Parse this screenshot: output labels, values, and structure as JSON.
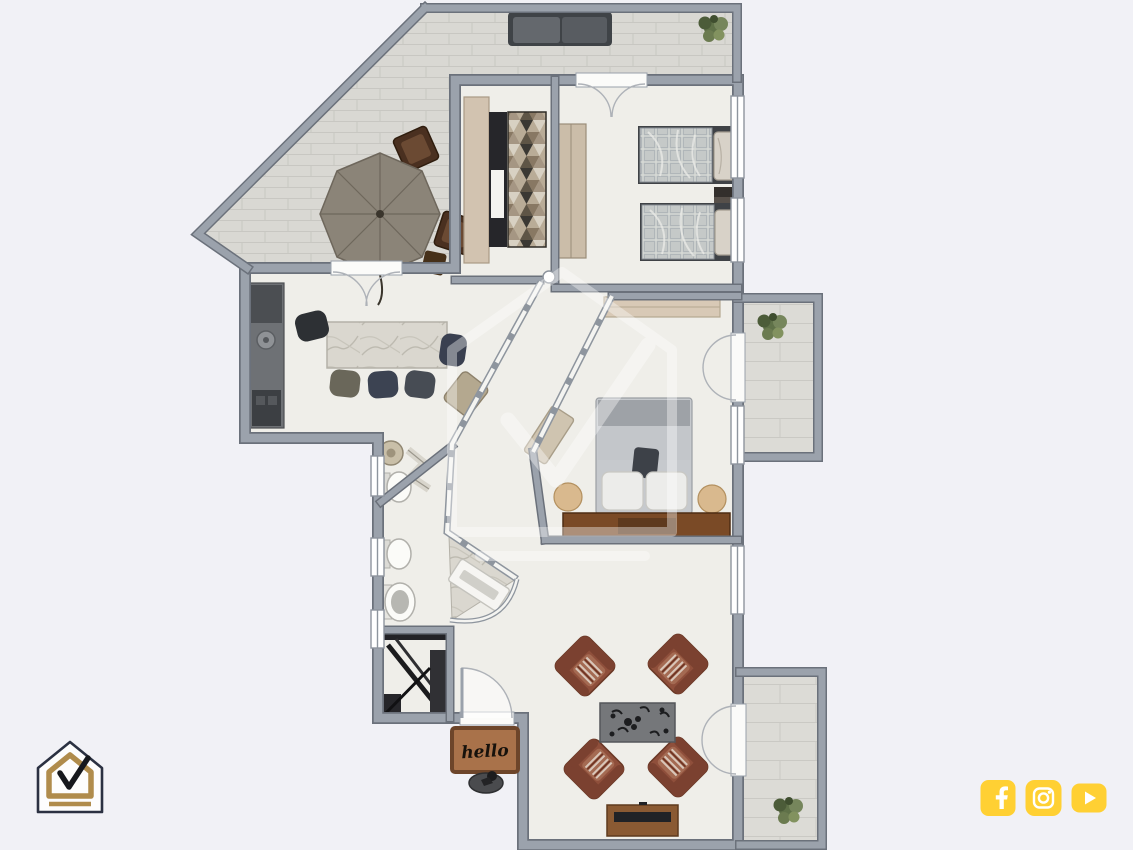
{
  "page": {
    "background_color": "#f1f1f6",
    "description": "furnished-apartment-floor-plan-render"
  },
  "branding": {
    "logo": {
      "name": "house-check-logo",
      "outline_color": "#2b3142",
      "accent_color": "#b08c4c",
      "check_color": "#16181d"
    },
    "social": {
      "accent_color": "#ffd033",
      "glyph_color": "#ffffff",
      "icons": [
        {
          "name": "facebook-icon"
        },
        {
          "name": "instagram-icon"
        },
        {
          "name": "youtube-icon"
        }
      ]
    }
  },
  "floorplan": {
    "doormat_text": "hello",
    "watermark": "house-check-watermark",
    "colors": {
      "floor": "#efeee9",
      "terrace_tile": "#d9d8d3",
      "wall": "#9ba2ac",
      "wall_outline": "#6b717b",
      "glass": "#f4f4f1",
      "doormat": "#a9724a",
      "doormat_border": "#6d452a",
      "leather_armchair": "#8f4f3b",
      "wood_dresser": "#7a4a26",
      "plant_green": "#5f7148"
    },
    "rooms": [
      {
        "name": "terrace",
        "floor": "tile",
        "furniture": [
          "outdoor-sofa",
          "parasol-table",
          "terrace-chair",
          "terrace-chair",
          "terrace-stool",
          "potted-plant"
        ]
      },
      {
        "name": "walk-in-closet",
        "furniture": [
          "tall-cabinet",
          "shelving-unit",
          "geometric-rug"
        ]
      },
      {
        "name": "twin-bedroom",
        "furniture": [
          "wardrobe",
          "twin-bed",
          "twin-bed",
          "nightstand"
        ]
      },
      {
        "name": "kitchen-dining",
        "furniture": [
          "kitchen-counter",
          "sink",
          "marble-dining-table",
          "dining-chair",
          "dining-chair",
          "dining-chair",
          "dining-chair",
          "dining-chair"
        ]
      },
      {
        "name": "hallway",
        "furniture": [
          "accent-armchair",
          "bench"
        ]
      },
      {
        "name": "bathroom-1",
        "furniture": [
          "washbasin",
          "toilet",
          "folding-screen"
        ]
      },
      {
        "name": "bathroom-2",
        "furniture": [
          "toilet",
          "pedestal-sink",
          "curved-shower"
        ]
      },
      {
        "name": "storage-closet",
        "furniture": [
          "dark-shelving"
        ]
      },
      {
        "name": "master-bedroom",
        "furniture": [
          "double-bed",
          "fitted-wardrobe",
          "wood-dresser",
          "pouf",
          "pouf"
        ]
      },
      {
        "name": "living-room",
        "furniture": [
          "leather-armchair",
          "leather-armchair",
          "leather-armchair",
          "leather-armchair",
          "floral-rug",
          "tv-console"
        ]
      },
      {
        "name": "balcony-east",
        "furniture": [
          "potted-plant"
        ]
      },
      {
        "name": "balcony-south",
        "furniture": [
          "potted-plant"
        ]
      },
      {
        "name": "entrance",
        "furniture": [
          "doormat",
          "decor-object"
        ]
      }
    ]
  }
}
